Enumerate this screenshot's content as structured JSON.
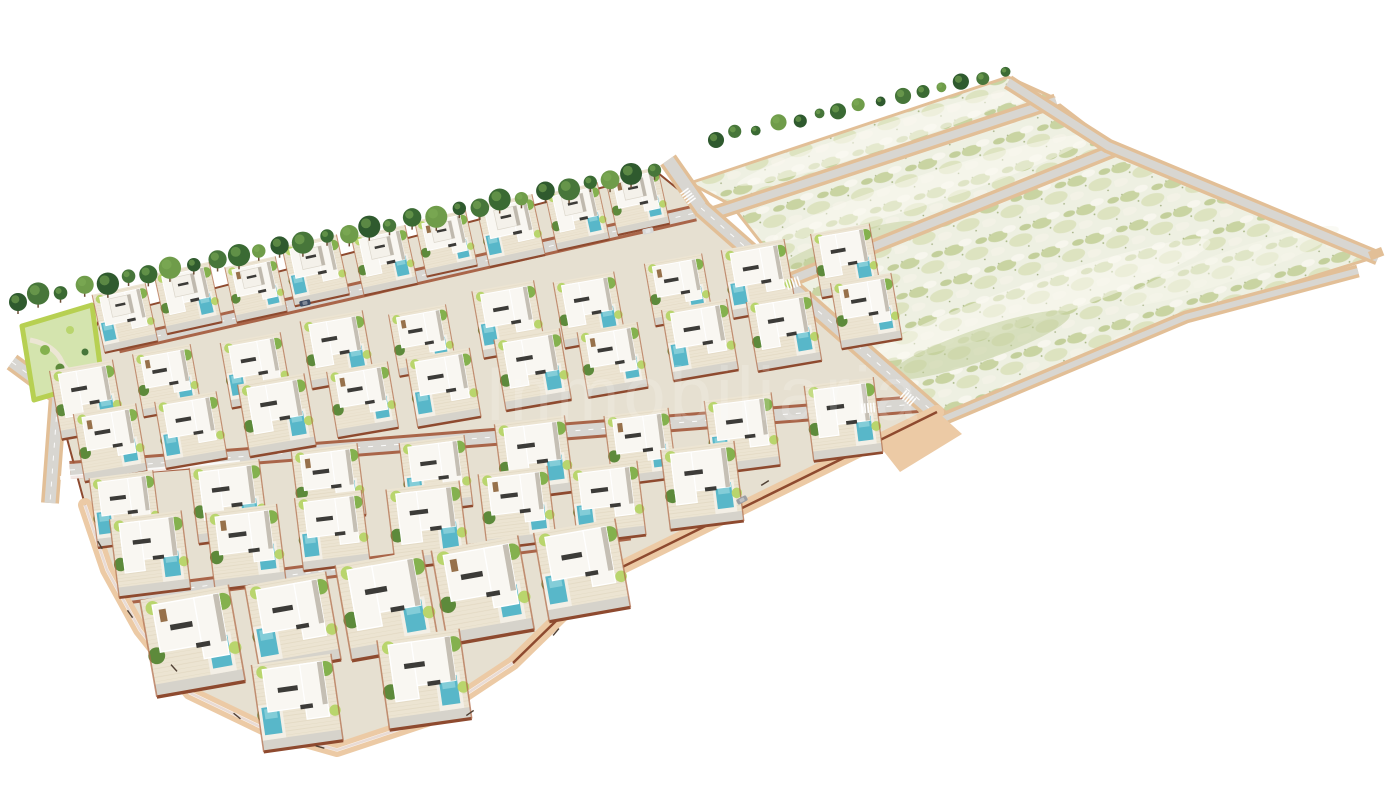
{
  "watermark": {
    "text": "Inmobiliaria",
    "color": "#ffffff",
    "opacity": 0.16,
    "font_size": 76,
    "x": 703,
    "y": 420,
    "letter_spacing": 4
  },
  "palette": {
    "background": "#ffffff",
    "villa_ground": "#e6e0d1",
    "patio": "#ece4d2",
    "driveway": "#d6d3cb",
    "road": "#d8d6d1",
    "road_dash": "#ffffff",
    "sand_edge": "#e2bf97",
    "promenade": "#eccaa5",
    "fence_dark": "#8e4a2f",
    "fence_light": "#b06a48",
    "red_edge": "#a2583a",
    "house_white": "#f9f7f2",
    "house_shadow": "#c5bfb4",
    "roof_trim": "#ffffff",
    "window_dark": "#3c3b38",
    "wood": "#97714b",
    "pool": "#58b7c9",
    "pool_light": "#8ed2dc",
    "pool_deck": "#f3efe6",
    "green_bright": "#b9d56d",
    "green_mid": "#84b14e",
    "green_deep": "#5d8a3b",
    "tree_dark": "#2f5a2e",
    "tree_mid": "#47763a",
    "tree_olive": "#3a6a33",
    "tree_light": "#6f9c4a",
    "trunk": "#6b4e35",
    "field_base": "#eef0e2",
    "scrub_green": "#c9d4a2",
    "scrub_soft": "#dde3c0",
    "scrub_pale": "#f7f6ed",
    "park_fill": "#d4e4ae",
    "park_border": "#b7d052",
    "park_path": "#ece6d4",
    "lamp": "#514135",
    "car_blue": "#3f4c63",
    "car_silver": "#d8d8d6",
    "car_gray": "#9b9ea3"
  },
  "scene": {
    "canvas": {
      "w": 1400,
      "h": 788
    },
    "villa_area": {
      "outline": [
        [
          100,
          318
        ],
        [
          658,
          173
        ],
        [
          700,
          207
        ],
        [
          940,
          418
        ],
        [
          600,
          578
        ],
        [
          513,
          663
        ],
        [
          427,
          720
        ],
        [
          337,
          750
        ],
        [
          267,
          730
        ],
        [
          190,
          693
        ],
        [
          140,
          630
        ],
        [
          107,
          570
        ],
        [
          85,
          505
        ],
        [
          62,
          420
        ],
        [
          78,
          368
        ]
      ]
    },
    "field_strips": [
      {
        "name": "field-strip-1",
        "points": [
          [
            690,
            183
          ],
          [
            1008,
            77
          ],
          [
            1052,
            97
          ],
          [
            735,
            207
          ]
        ]
      },
      {
        "name": "field-strip-2",
        "points": [
          [
            737,
            212
          ],
          [
            1060,
            105
          ],
          [
            1112,
            145
          ],
          [
            788,
            277
          ]
        ]
      },
      {
        "name": "field-strip-3",
        "points": [
          [
            793,
            285
          ],
          [
            1118,
            152
          ],
          [
            1372,
            258
          ],
          [
            1186,
            316
          ],
          [
            942,
            416
          ]
        ]
      }
    ],
    "field_streaks": [
      {
        "cx": 880,
        "cy": 138,
        "rx": 150,
        "ry": 12,
        "rot": -18,
        "fill": "#fbfaf2",
        "op": 0.55
      },
      {
        "cx": 930,
        "cy": 188,
        "rx": 165,
        "ry": 15,
        "rot": -18,
        "fill": "#fbfaf2",
        "op": 0.5
      },
      {
        "cx": 1040,
        "cy": 300,
        "rx": 180,
        "ry": 20,
        "rot": -19,
        "fill": "#fbfaf2",
        "op": 0.5
      },
      {
        "cx": 1230,
        "cy": 266,
        "rx": 115,
        "ry": 15,
        "rot": -19,
        "fill": "#f6f5ea",
        "op": 0.5
      },
      {
        "cx": 980,
        "cy": 345,
        "rx": 95,
        "ry": 16,
        "rot": -19,
        "fill": "#c3d09c",
        "op": 0.55
      },
      {
        "cx": 850,
        "cy": 245,
        "rx": 70,
        "ry": 11,
        "rot": -18,
        "fill": "#c3d09c",
        "op": 0.5
      }
    ],
    "field_roads": [
      {
        "name": "field-road-1",
        "pts": [
          [
            706,
            216
          ],
          [
            1056,
            101
          ]
        ],
        "w": 8,
        "edge": "sand"
      },
      {
        "name": "field-road-2",
        "pts": [
          [
            788,
            281
          ],
          [
            1116,
            149
          ]
        ],
        "w": 8,
        "edge": "sand"
      },
      {
        "name": "field-road-right",
        "pts": [
          [
            1008,
            82
          ],
          [
            1108,
            146
          ],
          [
            1378,
            258
          ]
        ],
        "w": 8,
        "edge": "sand"
      },
      {
        "name": "field-road-bottom",
        "pts": [
          [
            941,
            420
          ],
          [
            1186,
            317
          ],
          [
            1358,
            271
          ]
        ],
        "w": 6,
        "edge": "sand"
      }
    ],
    "villa_roads": [
      {
        "name": "road-left-edge",
        "pts": [
          [
            12,
            362
          ],
          [
            58,
            396
          ],
          [
            50,
            503
          ]
        ],
        "w": 11,
        "edge": "sand",
        "dash": true
      },
      {
        "name": "road-top",
        "pts": [
          [
            118,
            345
          ],
          [
            695,
            213
          ]
        ],
        "w": 11,
        "edge": "red",
        "dash": true
      },
      {
        "name": "road-mid",
        "pts": [
          [
            70,
            470
          ],
          [
            918,
            404
          ]
        ],
        "w": 12,
        "edge": "red",
        "dash": true
      },
      {
        "name": "road-low",
        "pts": [
          [
            125,
            596
          ],
          [
            630,
            532
          ]
        ],
        "w": 11,
        "edge": "red",
        "dash": true
      },
      {
        "name": "road-entrance",
        "pts": [
          [
            668,
            160
          ],
          [
            703,
            210
          ]
        ],
        "w": 12,
        "edge": "sand"
      },
      {
        "name": "road-perimeter",
        "pts": [
          [
            701,
            208
          ],
          [
            940,
            418
          ]
        ],
        "w": 12,
        "edge": "sand",
        "dash": true
      }
    ],
    "villa_rows": [
      {
        "name": "villa-row-a",
        "from": [
          125,
          315
        ],
        "to": [
          640,
          202
        ],
        "count": 9,
        "scale": 0.85,
        "twoStory": true
      },
      {
        "name": "villa-row-b",
        "from": [
          85,
          398
        ],
        "to": [
          845,
          262
        ],
        "count": 10,
        "scale": 0.95
      },
      {
        "name": "villa-row-c",
        "from": [
          108,
          444
        ],
        "to": [
          868,
          314
        ],
        "count": 10,
        "scale": 1.0
      },
      {
        "name": "villa-row-d",
        "from": [
          125,
          512
        ],
        "to": [
          845,
          420
        ],
        "count": 8,
        "scale": 1.05
      },
      {
        "name": "villa-row-e",
        "from": [
          152,
          556
        ],
        "to": [
          700,
          488
        ],
        "count": 7,
        "scale": 1.1
      },
      {
        "name": "villa-row-f",
        "from": [
          195,
          640
        ],
        "to": [
          580,
          572
        ],
        "count": 5,
        "scale": 1.35
      },
      {
        "name": "villa-row-tip",
        "from": [
          298,
          700
        ],
        "to": [
          425,
          682
        ],
        "count": 2,
        "scale": 1.3
      }
    ],
    "tree_rows": [
      {
        "name": "tree-row-villa-edge",
        "from": [
          18,
          300
        ],
        "to": [
          655,
          170
        ],
        "count": 30,
        "r": 9,
        "trunk": true
      },
      {
        "name": "tree-row-field-edge",
        "from": [
          716,
          138
        ],
        "to": [
          1004,
          73
        ],
        "count": 15,
        "r": 6.5,
        "trunk": false
      }
    ],
    "park": {
      "outline": [
        [
          22,
          326
        ],
        [
          92,
          305
        ],
        [
          102,
          380
        ],
        [
          34,
          400
        ]
      ]
    },
    "promenade": {
      "pts": [
        [
          85,
          505
        ],
        [
          107,
          570
        ],
        [
          140,
          630
        ],
        [
          190,
          693
        ],
        [
          267,
          730
        ],
        [
          337,
          750
        ],
        [
          427,
          720
        ],
        [
          513,
          663
        ],
        [
          600,
          578
        ],
        [
          937,
          412
        ]
      ],
      "w": 14
    },
    "junction_wedge": [
      [
        878,
        444
      ],
      [
        942,
        416
      ],
      [
        962,
        434
      ],
      [
        900,
        472
      ]
    ],
    "right_stub": {
      "x": 1368,
      "y": 252,
      "w": 14,
      "h": 9,
      "rot": -21
    },
    "crosswalks": [
      {
        "x": 688,
        "y": 196,
        "rot": 54
      },
      {
        "x": 908,
        "y": 398,
        "rot": 41
      },
      {
        "x": 793,
        "y": 283,
        "rot": -18
      },
      {
        "x": 868,
        "y": 408,
        "rot": -5
      }
    ],
    "cars": [
      {
        "x": 305,
        "y": 303,
        "rot": -12,
        "color": "car_blue"
      },
      {
        "x": 648,
        "y": 231,
        "rot": -12,
        "color": "car_silver"
      },
      {
        "x": 742,
        "y": 500,
        "rot": -28,
        "color": "car_gray"
      }
    ],
    "lamps": [
      {
        "x": 100,
        "y": 545,
        "rot": 60
      },
      {
        "x": 130,
        "y": 614,
        "rot": 55
      },
      {
        "x": 174,
        "y": 668,
        "rot": 48
      },
      {
        "x": 237,
        "y": 716,
        "rot": 40
      },
      {
        "x": 320,
        "y": 747,
        "rot": 15
      },
      {
        "x": 470,
        "y": 713,
        "rot": -35
      },
      {
        "x": 556,
        "y": 632,
        "rot": -50
      },
      {
        "x": 765,
        "y": 483,
        "rot": -32
      }
    ]
  }
}
